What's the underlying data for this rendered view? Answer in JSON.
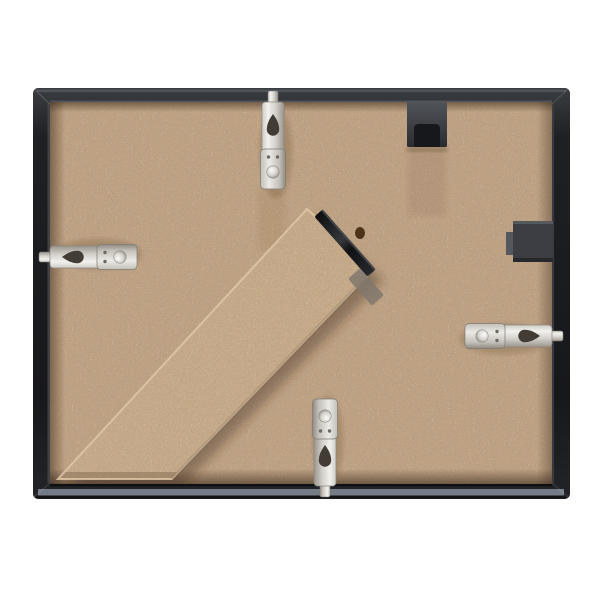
{
  "scene": {
    "alt": "Rear view of a black picture frame: tan hardboard backing, diagonal fold-out easel stand with black hinge, four silver swivel hanging clips and two black hanging brackets on a white background",
    "background": "#ffffff"
  },
  "colors": {
    "frame_body": "#1d1f22",
    "frame_top_highlight": "#53575d",
    "frame_bottom_reflection": "#767c85",
    "frame_inner_lip": "#494d53",
    "frame_edge_dark": "#141517",
    "backing": "#bfa183",
    "backing_speckle_dark": "#6f5335",
    "backing_speckle_light": "#e3cfae",
    "stand": "#c7ab8a",
    "stand_edge_highlight": "#dfc8a7",
    "hinge": "#1b1d1f",
    "hinge_slot": "#80786c",
    "knot": "#4f3319",
    "metal_light": "#f2f1ed",
    "metal_mid": "#c9c7c2",
    "metal_dark": "#908c85",
    "metal_hole": "#423c34",
    "bracket_top": "#3f4246",
    "bracket_top_slot": "#17181b",
    "bracket_side": "#3c3e43",
    "bracket_side_step": "#54575c",
    "shadow_soft": "rgba(56,36,18,0.40)"
  },
  "parts": {
    "frame": "black frame moulding",
    "backing": "hardboard backing panel",
    "stand": "fold-out easel stand",
    "hinge": "easel hinge",
    "hinge_slot": "hinge recess",
    "knot": "wood knot",
    "bracket_top": "top hanging bracket",
    "bracket_side": "side hanging bracket",
    "clip_top": "top swivel hanging clip",
    "clip_left": "left swivel hanging clip",
    "clip_right": "right swivel hanging clip",
    "clip_bottom": "bottom swivel hanging clip"
  }
}
